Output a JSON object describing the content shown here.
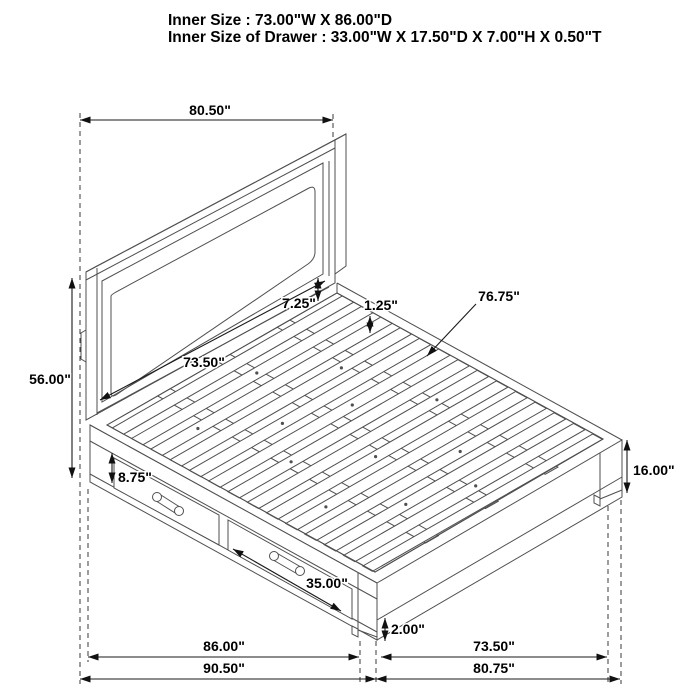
{
  "header": {
    "line1": "Inner Size : 73.00\"W X 86.00\"D",
    "line2": "Inner Size of Drawer : 33.00\"W X 17.50\"D X 7.00\"H X 0.50\"T"
  },
  "dims": {
    "headboard_width": "80.50\"",
    "headboard_height": "56.00\"",
    "headboard_inner_width": "73.50\"",
    "panel_gap": "7.25\"",
    "slat_recess": "1.25\"",
    "slat_length": "76.75\"",
    "drawer_front_height": "8.75\"",
    "platform_height": "16.00\"",
    "drawer_width": "35.00\"",
    "foot_clearance": "2.00\"",
    "inner_depth": "86.00\"",
    "outer_depth": "90.50\"",
    "footboard_inner_width": "73.50\"",
    "footboard_width": "80.75\""
  },
  "colors": {
    "line": "#4f4f4f",
    "dimension": "#1a1a1a",
    "text": "#000000",
    "background": "#ffffff"
  }
}
